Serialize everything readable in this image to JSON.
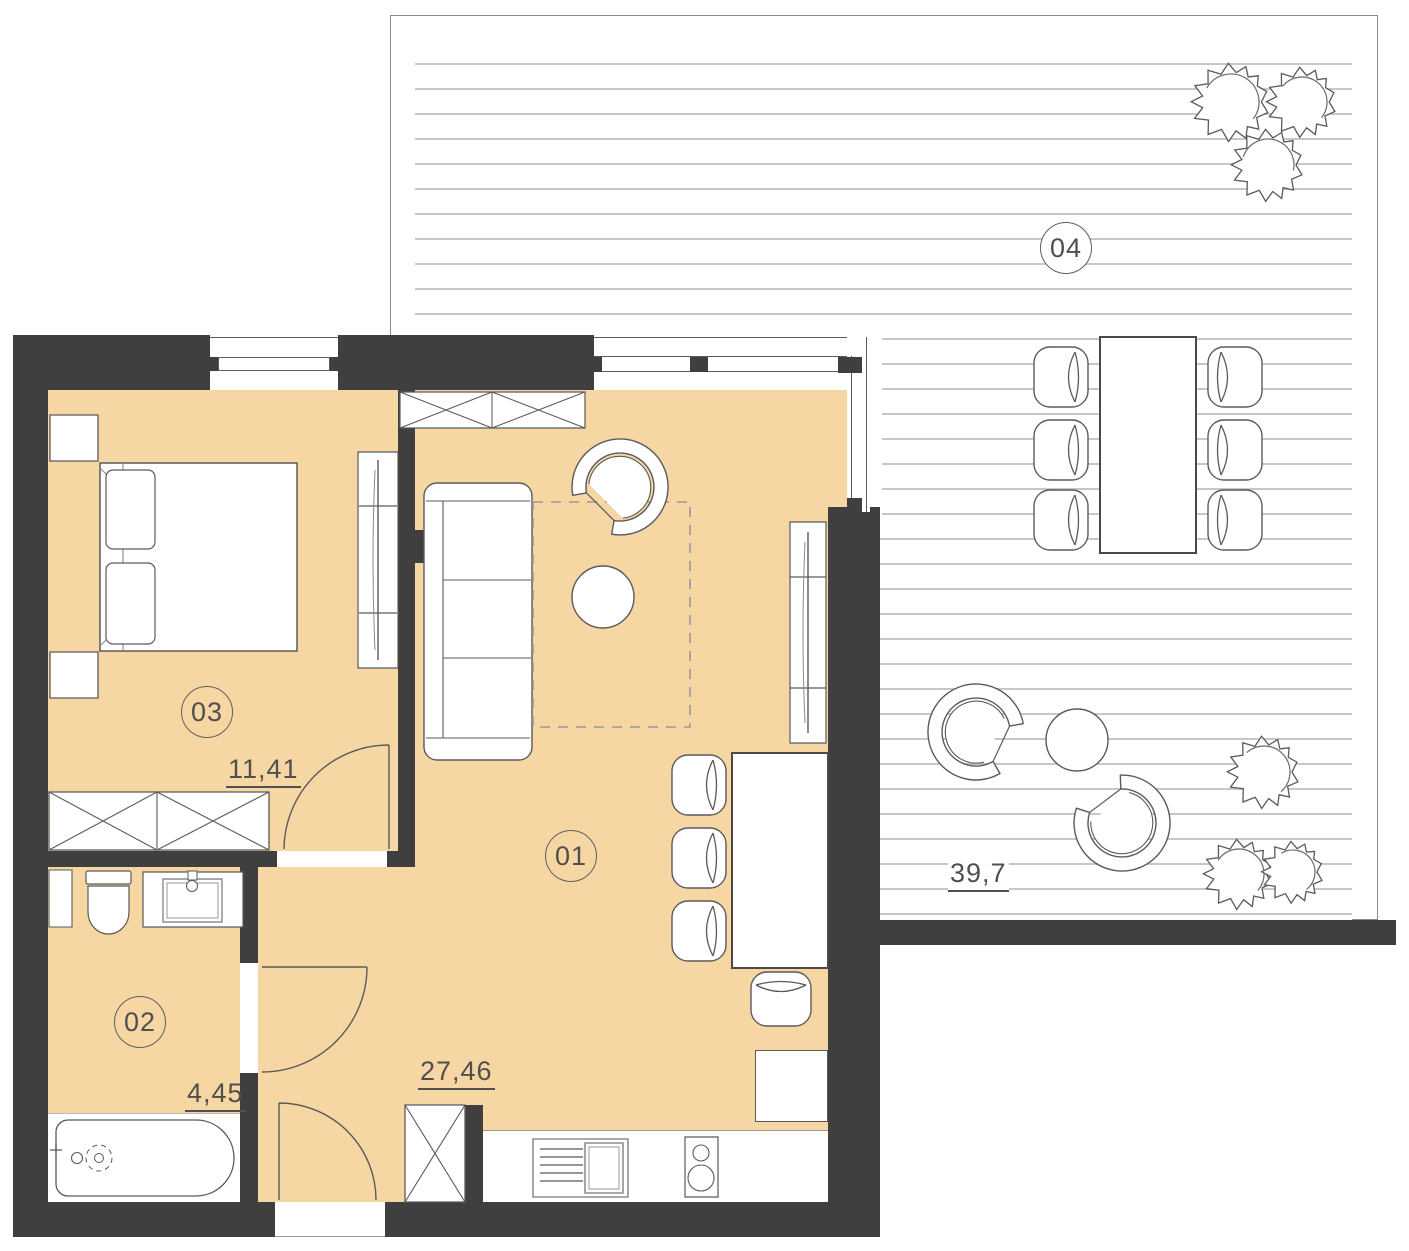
{
  "plan": {
    "title": "Apartment floor plan",
    "rooms": [
      {
        "key": "living-kitchen",
        "id": "01",
        "area": "27,46"
      },
      {
        "key": "bathroom",
        "id": "02",
        "area": "4,45"
      },
      {
        "key": "bedroom",
        "id": "03",
        "area": "11,41"
      },
      {
        "key": "terrace",
        "id": "04",
        "area": "39,7"
      }
    ],
    "colors": {
      "wall": "#3f3f3f",
      "floor": "#f6d7a4",
      "deck_line": "#c7c7c7",
      "outline": "#5a5a5a",
      "label_text": "#4f4f4f"
    }
  }
}
